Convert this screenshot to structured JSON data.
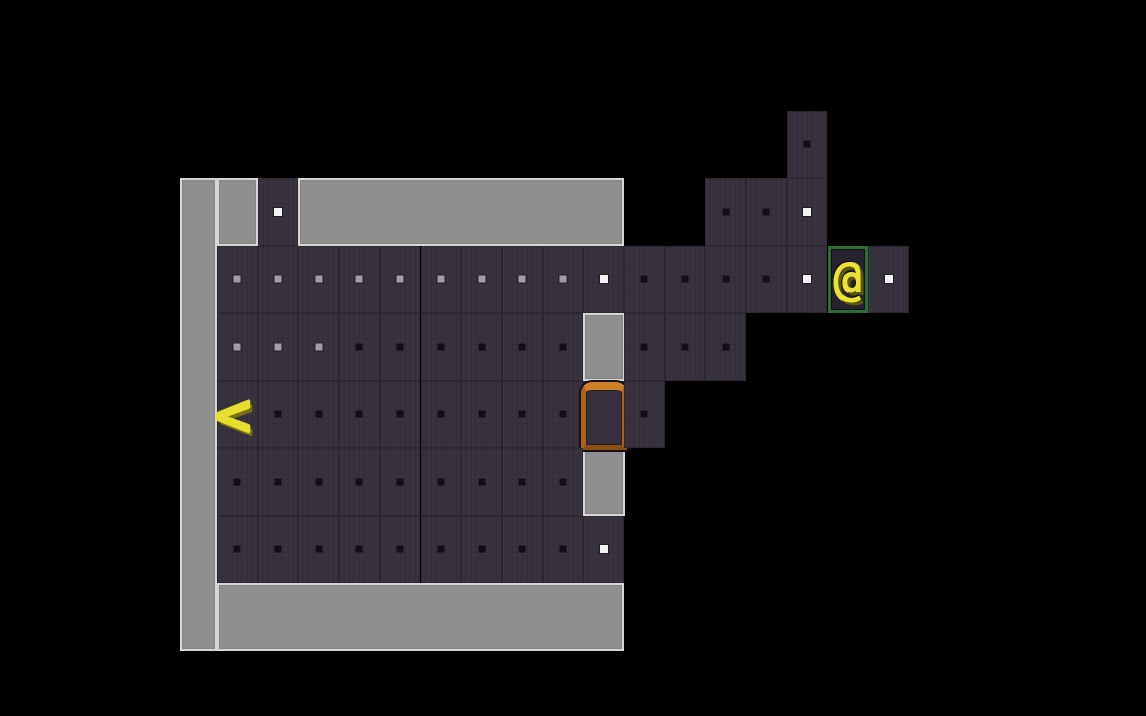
{
  "scene": {
    "background": "#000000",
    "description": "roguelike-dungeon-map-view"
  },
  "palette": {
    "wall": "#8f8f8f",
    "wall_highlight": "#d6d6d6",
    "floor": "#38323f",
    "dot_dark": "#120d18",
    "dot_gray": "#a29cab",
    "dot_white": "#f2f2f2",
    "door_frame": "#ad6418",
    "door_frame_light": "#cd8128",
    "door_frame_dark": "#8a5012",
    "door_outline": "#151020",
    "door_interior": "#352f3e",
    "player_glyph_color": "#eae334",
    "player_glyph_shadow": "#5c560f",
    "player_tile_border": "#2b6e2f",
    "player_tile_bg": "#282331",
    "stairs_glyph_color": "#e6df2d",
    "stairs_glyph_shadow": "#77700f"
  },
  "grid": {
    "origin_x": 217,
    "origin_y": 110.5,
    "tile_w": 40.7,
    "tile_h": 67.5,
    "cols": 17,
    "rows": 8
  },
  "legend": {
    ".": "unexplored-black",
    "f": "floor-dark-dot",
    "g": "floor-gray-dot",
    "w": "floor-white-dot",
    "@": "player-on-floor",
    "<": "stairs-up-on-floor",
    "D": "open-door"
  },
  "map_rows": [
    "..............f..",
    ".w..........ffw..",
    "gggggggggwffffw@w",
    "gggffffff.fff....",
    "<ffffffffDf......",
    "fffffffff........",
    "fffffffffw.......",
    "................."
  ],
  "walls": [
    {
      "name": "left-wall",
      "x": 180,
      "y": 178,
      "w": 37,
      "h": 473
    },
    {
      "name": "top-wall-left",
      "x": 217,
      "y": 178,
      "w": 41,
      "h": 68
    },
    {
      "name": "top-wall-right",
      "x": 298,
      "y": 178,
      "w": 326,
      "h": 68
    },
    {
      "name": "bottom-wall",
      "x": 217,
      "y": 583,
      "w": 407,
      "h": 68
    },
    {
      "name": "right-wall-upper",
      "x": 583,
      "y": 313,
      "w": 42,
      "h": 68
    },
    {
      "name": "right-wall-lower",
      "x": 583,
      "y": 448,
      "w": 42,
      "h": 68
    }
  ],
  "player": {
    "glyph": "@",
    "col": 15,
    "row": 2
  },
  "stairs_up": {
    "glyph": "<",
    "col": 0,
    "row": 4
  },
  "door": {
    "col": 9,
    "row": 4
  }
}
